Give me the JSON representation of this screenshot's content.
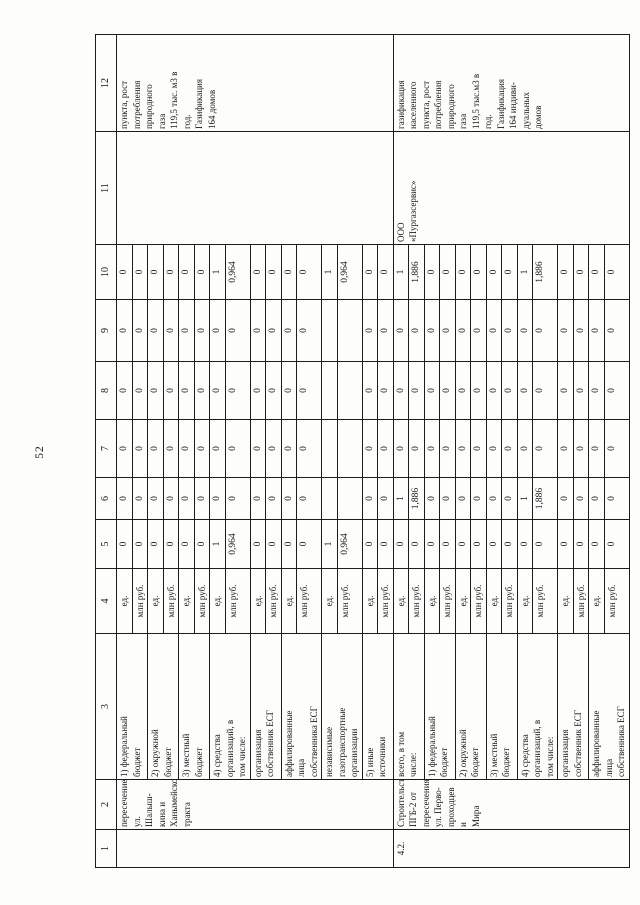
{
  "document": {
    "page_number": "52",
    "table": {
      "column_numbers": [
        "1",
        "2",
        "3",
        "4",
        "5",
        "6",
        "7",
        "8",
        "9",
        "10",
        "11",
        "12"
      ],
      "unit_count": "ед.",
      "unit_money": "млн руб.",
      "groups": [
        {
          "number": "",
          "name": "пересечение\nул. Шалыш-\nкина и\nХанымейского\nтракта",
          "executor": "",
          "result": "пункта, рост\nпотребления\nприродного\nгаза\n119,5 тыс. м3 в\nгод.\nГазификация\n164 домов",
          "subrows": [
            {
              "label": "1) федеральный\nбюджет",
              "ed": [
                "0",
                "0",
                "0",
                "0",
                "0",
                "0"
              ],
              "mln": [
                "0",
                "0",
                "0",
                "0",
                "0",
                "0"
              ]
            },
            {
              "label": "2) окружной\nбюджет",
              "ed": [
                "0",
                "0",
                "0",
                "0",
                "0",
                "0"
              ],
              "mln": [
                "0",
                "0",
                "0",
                "0",
                "0",
                "0"
              ]
            },
            {
              "label": "3) местный\nбюджет",
              "ed": [
                "0",
                "0",
                "0",
                "0",
                "0",
                "0"
              ],
              "mln": [
                "0",
                "0",
                "0",
                "0",
                "0",
                "0"
              ]
            },
            {
              "label": "4) средства\nорганизаций, в\nтом числе:",
              "ed": [
                "1",
                "0",
                "0",
                "0",
                "0",
                "1"
              ],
              "mln": [
                "0,964",
                "0",
                "0",
                "0",
                "0",
                "0,964"
              ]
            },
            {
              "label": "организация\nсобственник ЕСГ",
              "ed": [
                "0",
                "0",
                "0",
                "0",
                "0",
                "0"
              ],
              "mln": [
                "0",
                "0",
                "0",
                "0",
                "0",
                "0"
              ]
            },
            {
              "label": "аффилированные\nлица\nсобственника ЕСГ",
              "ed": [
                "0",
                "0",
                "0",
                "0",
                "0",
                "0"
              ],
              "mln": [
                "0",
                "0",
                "0",
                "0",
                "0",
                "0"
              ]
            },
            {
              "label": "независимые\nгазотранспортные\nорганизации",
              "ed": [
                "1",
                "",
                "",
                "",
                "",
                "1"
              ],
              "mln": [
                "0,964",
                "",
                "",
                "",
                "",
                "0,964"
              ]
            },
            {
              "label": "5) иные\nисточники",
              "ed": [
                "0",
                "0",
                "0",
                "0",
                "0",
                "0"
              ],
              "mln": [
                "0",
                "0",
                "0",
                "0",
                "0",
                "0"
              ]
            }
          ]
        },
        {
          "number": "4.2.",
          "name": "Строительство\nПГБ-2 от\nпересечения\nул. Перво-\nпроходцев и\nМира",
          "executor": "ООО\n«Пургазсервис»",
          "result": "газификация\nнаселенного\nпункта, рост\nпотребления\nприродного\nгаза\n119,5 тыс.м3 в\nгод.\nГазификация\n164 индиви-\nдуальных\nдомов",
          "subrows": [
            {
              "label": "всего, в том\nчисле:",
              "ed": [
                "0",
                "1",
                "0",
                "0",
                "0",
                "1"
              ],
              "mln": [
                "0",
                "1,886",
                "0",
                "0",
                "0",
                "1,886"
              ]
            },
            {
              "label": "1) федеральный\nбюджет",
              "ed": [
                "0",
                "0",
                "0",
                "0",
                "0",
                "0"
              ],
              "mln": [
                "0",
                "0",
                "0",
                "0",
                "0",
                "0"
              ]
            },
            {
              "label": "2) окружной\nбюджет",
              "ed": [
                "0",
                "0",
                "0",
                "0",
                "0",
                "0"
              ],
              "mln": [
                "0",
                "0",
                "0",
                "0",
                "0",
                "0"
              ]
            },
            {
              "label": "3) местный\nбюджет",
              "ed": [
                "0",
                "0",
                "0",
                "0",
                "0",
                "0"
              ],
              "mln": [
                "0",
                "0",
                "0",
                "0",
                "0",
                "0"
              ]
            },
            {
              "label": "4) средства\nорганизаций, в\nтом числе:",
              "ed": [
                "0",
                "1",
                "0",
                "0",
                "0",
                "1"
              ],
              "mln": [
                "0",
                "1,886",
                "0",
                "0",
                "0",
                "1,886"
              ]
            },
            {
              "label": "организация\nсобственник ЕСГ",
              "ed": [
                "0",
                "0",
                "0",
                "0",
                "0",
                "0"
              ],
              "mln": [
                "0",
                "0",
                "0",
                "0",
                "0",
                "0"
              ]
            },
            {
              "label": "аффилированные\nлица\nсобственника ЕСГ",
              "ed": [
                "0",
                "0",
                "0",
                "0",
                "0",
                "0"
              ],
              "mln": [
                "0",
                "0",
                "0",
                "0",
                "0",
                "0"
              ]
            }
          ]
        }
      ]
    }
  }
}
